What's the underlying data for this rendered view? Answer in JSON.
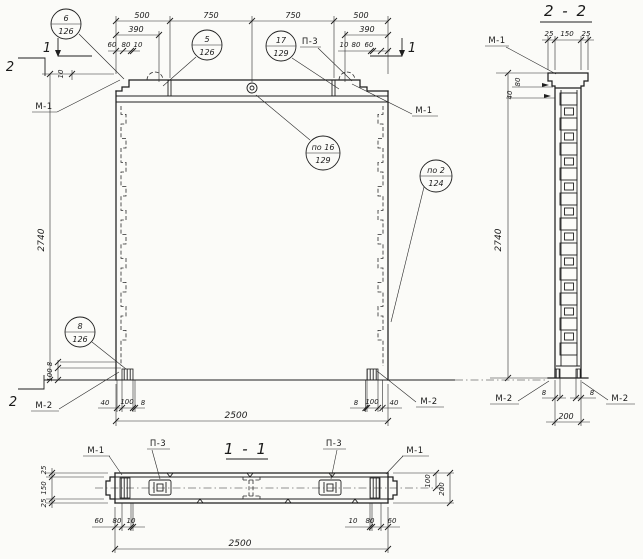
{
  "palette": {
    "paper": "#fbfbf8",
    "ink": "#1f1f1f"
  },
  "titles": {
    "section22": "2 - 2",
    "section11": "1 - 1"
  },
  "labels": {
    "m1": "М-1",
    "m2": "М-2",
    "p3": "П-3",
    "cut1": "1",
    "cut2": "2"
  },
  "balloons": {
    "b6": {
      "num": "6",
      "sheet": "126"
    },
    "b5": {
      "num": "5",
      "sheet": "126"
    },
    "b17": {
      "num": "17",
      "sheet": "129"
    },
    "b16": {
      "num": "по 16",
      "sheet": "129"
    },
    "b2": {
      "num": "по 2",
      "sheet": "124"
    },
    "b8": {
      "num": "8",
      "sheet": "126"
    }
  },
  "elevation": {
    "top_chain": [
      "500",
      "750",
      "750",
      "500"
    ],
    "offset_left": "390",
    "offset_right": "390",
    "edge_left": [
      "60",
      "80",
      "10"
    ],
    "edge_right": [
      "10",
      "80",
      "60"
    ],
    "height": "2740",
    "step": "10",
    "corner_vert": [
      "8",
      "100"
    ],
    "corner_left": [
      "40",
      "100",
      "8"
    ],
    "corner_right": [
      "8",
      "100",
      "40"
    ],
    "overall": "2500"
  },
  "section22": {
    "top_chain": [
      "25",
      "150",
      "25"
    ],
    "cap_dims": [
      "80",
      "40"
    ],
    "height": "2740",
    "edge": [
      "8",
      "8"
    ],
    "overall": "200"
  },
  "section11": {
    "thickness": [
      "25",
      "150",
      "25"
    ],
    "right_dims": [
      "100",
      "200"
    ],
    "edge_left": [
      "60",
      "80",
      "10"
    ],
    "edge_right": [
      "10",
      "80",
      "60"
    ],
    "overall": "2500"
  }
}
